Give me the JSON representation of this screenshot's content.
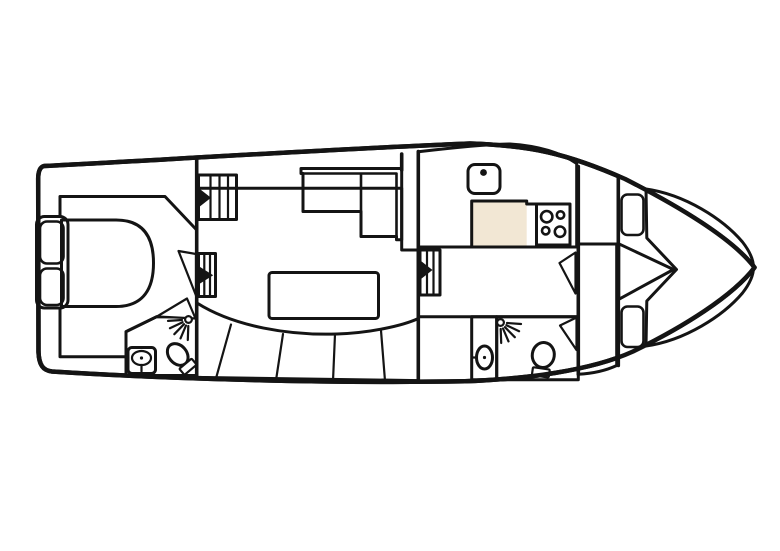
{
  "diagram": {
    "type": "boat-floorplan",
    "orientation": "bow-right",
    "rooms": [
      "aft-cabin",
      "aft-bathroom",
      "salon",
      "galley",
      "corridor",
      "fore-bathroom",
      "bow-cabin"
    ],
    "features": {
      "aft_cabin": [
        "double-bed",
        "two-pillows",
        "companionway-steps"
      ],
      "aft_bathroom": [
        "washbasin",
        "toilet",
        "shower-head"
      ],
      "salon": [
        "l-shaped-sofa",
        "dining-table",
        "curved-bench-seating",
        "steps"
      ],
      "galley": [
        "sink",
        "four-burner-stove"
      ],
      "fore_bathroom": [
        "washbasin",
        "toilet",
        "shower-head"
      ],
      "bow_cabin": [
        "v-berth-bed",
        "two-pillows",
        "bow-hatch-steps"
      ]
    }
  },
  "colors": {
    "hull": "#b9593a",
    "floor": "#f2e7d4",
    "seating": "#f6c31f",
    "counter": "#7fa185",
    "bed": "#9b97e1",
    "pillow": "#c7c4ef",
    "bathroom": "#e1f5f8",
    "basin_panel": "#a6c9e8",
    "basin_box": "#cfe2f4",
    "steps": "#d7c98f",
    "hatch": "#2b2b62",
    "fixture": "#ffffff",
    "outline": "#141414",
    "background": "#ffffff"
  }
}
